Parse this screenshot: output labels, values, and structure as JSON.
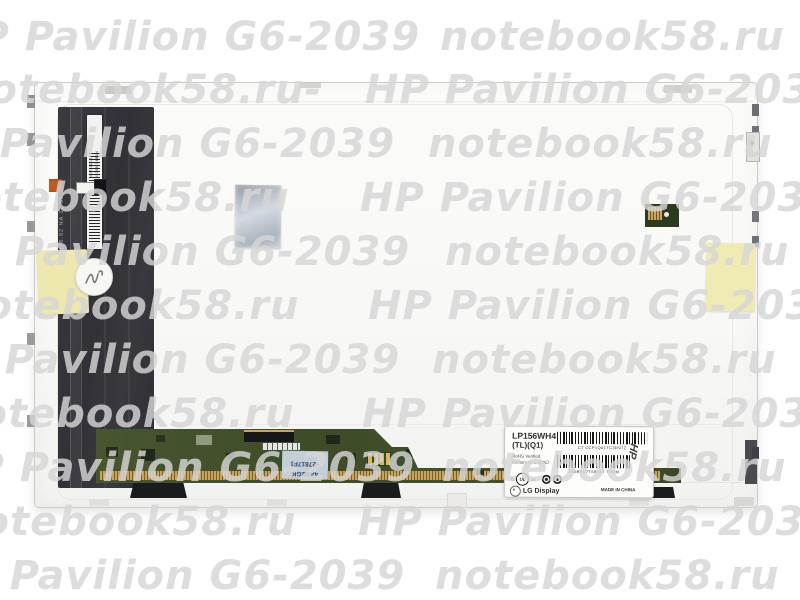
{
  "page": {
    "background": "#ffffff"
  },
  "watermark": {
    "color": "#d5d5d5",
    "rows": [
      {
        "y": 14,
        "segments": [
          {
            "text": "HP Pavilion G6-2039",
            "x": -55
          },
          {
            "text": "notebook58.ru",
            "x": 440
          }
        ]
      },
      {
        "y": 67,
        "segments": [
          {
            "text": "notebook58.ru-",
            "x": -40
          },
          {
            "text": "HP Pavilion G6-2039",
            "x": 365
          }
        ]
      },
      {
        "y": 121,
        "segments": [
          {
            "text": "HP Pavilion G6-2039",
            "x": -80
          },
          {
            "text": "notebook58.ru",
            "x": 428
          }
        ]
      },
      {
        "y": 175,
        "segments": [
          {
            "text": "notebook58.ru",
            "x": -55
          },
          {
            "text": "HP Pavilion G6-2039",
            "x": 360
          }
        ]
      },
      {
        "y": 229,
        "segments": [
          {
            "text": "HP Pavilion G6-2039",
            "x": -65
          },
          {
            "text": "notebook58.ru",
            "x": 445
          }
        ]
      },
      {
        "y": 283,
        "segments": [
          {
            "text": "notebook58.ru",
            "x": -45
          },
          {
            "text": "HP Pavilion G6-2039",
            "x": 368
          }
        ]
      },
      {
        "y": 337,
        "segments": [
          {
            "text": "HP Pavilion G6-2039",
            "x": -75
          },
          {
            "text": "notebook58.ru",
            "x": 432
          }
        ]
      },
      {
        "y": 391,
        "segments": [
          {
            "text": "notebook58.ru",
            "x": -50
          },
          {
            "text": "HP Pavilion G6-2039",
            "x": 362
          }
        ]
      },
      {
        "y": 445,
        "segments": [
          {
            "text": "HP Pavilion G6-2039",
            "x": -60
          },
          {
            "text": "notebook58.ru",
            "x": 442
          }
        ]
      },
      {
        "y": 499,
        "segments": [
          {
            "text": "notebook58.ru",
            "x": -48
          },
          {
            "text": "HP Pavilion G6-2039",
            "x": 358
          }
        ]
      },
      {
        "y": 553,
        "segments": [
          {
            "text": "HP Pavilion G6-2039",
            "x": -70
          },
          {
            "text": "notebook58.ru",
            "x": 435
          }
        ]
      }
    ]
  },
  "panel": {
    "back_texts": {
      "side_code": "55508-09476.82   NA 11 38 D",
      "sticker_line1": "NDR 2D16",
      "sticker_line2": "55368-T4B0N"
    },
    "pcb_sticker": {
      "line1": "4AN2GK",
      "line2": "+27817F1"
    },
    "info_label": {
      "model": "LP156WH4",
      "revision": "(TL)(Q1)",
      "rohs": "RoHS Verified",
      "factory_id": "Factory ID LGDNJ",
      "barcode1_text": "CT CCP1Q61TC3R97Z",
      "barcode2_text": "156BBC7T69LA7  TM2M",
      "handwritten_mark": "HP",
      "ul_prefix": "c",
      "ul_text": "UL",
      "ul_suffix": "us",
      "brand": "LG Display",
      "made_in": "MADE IN CHINA"
    }
  }
}
